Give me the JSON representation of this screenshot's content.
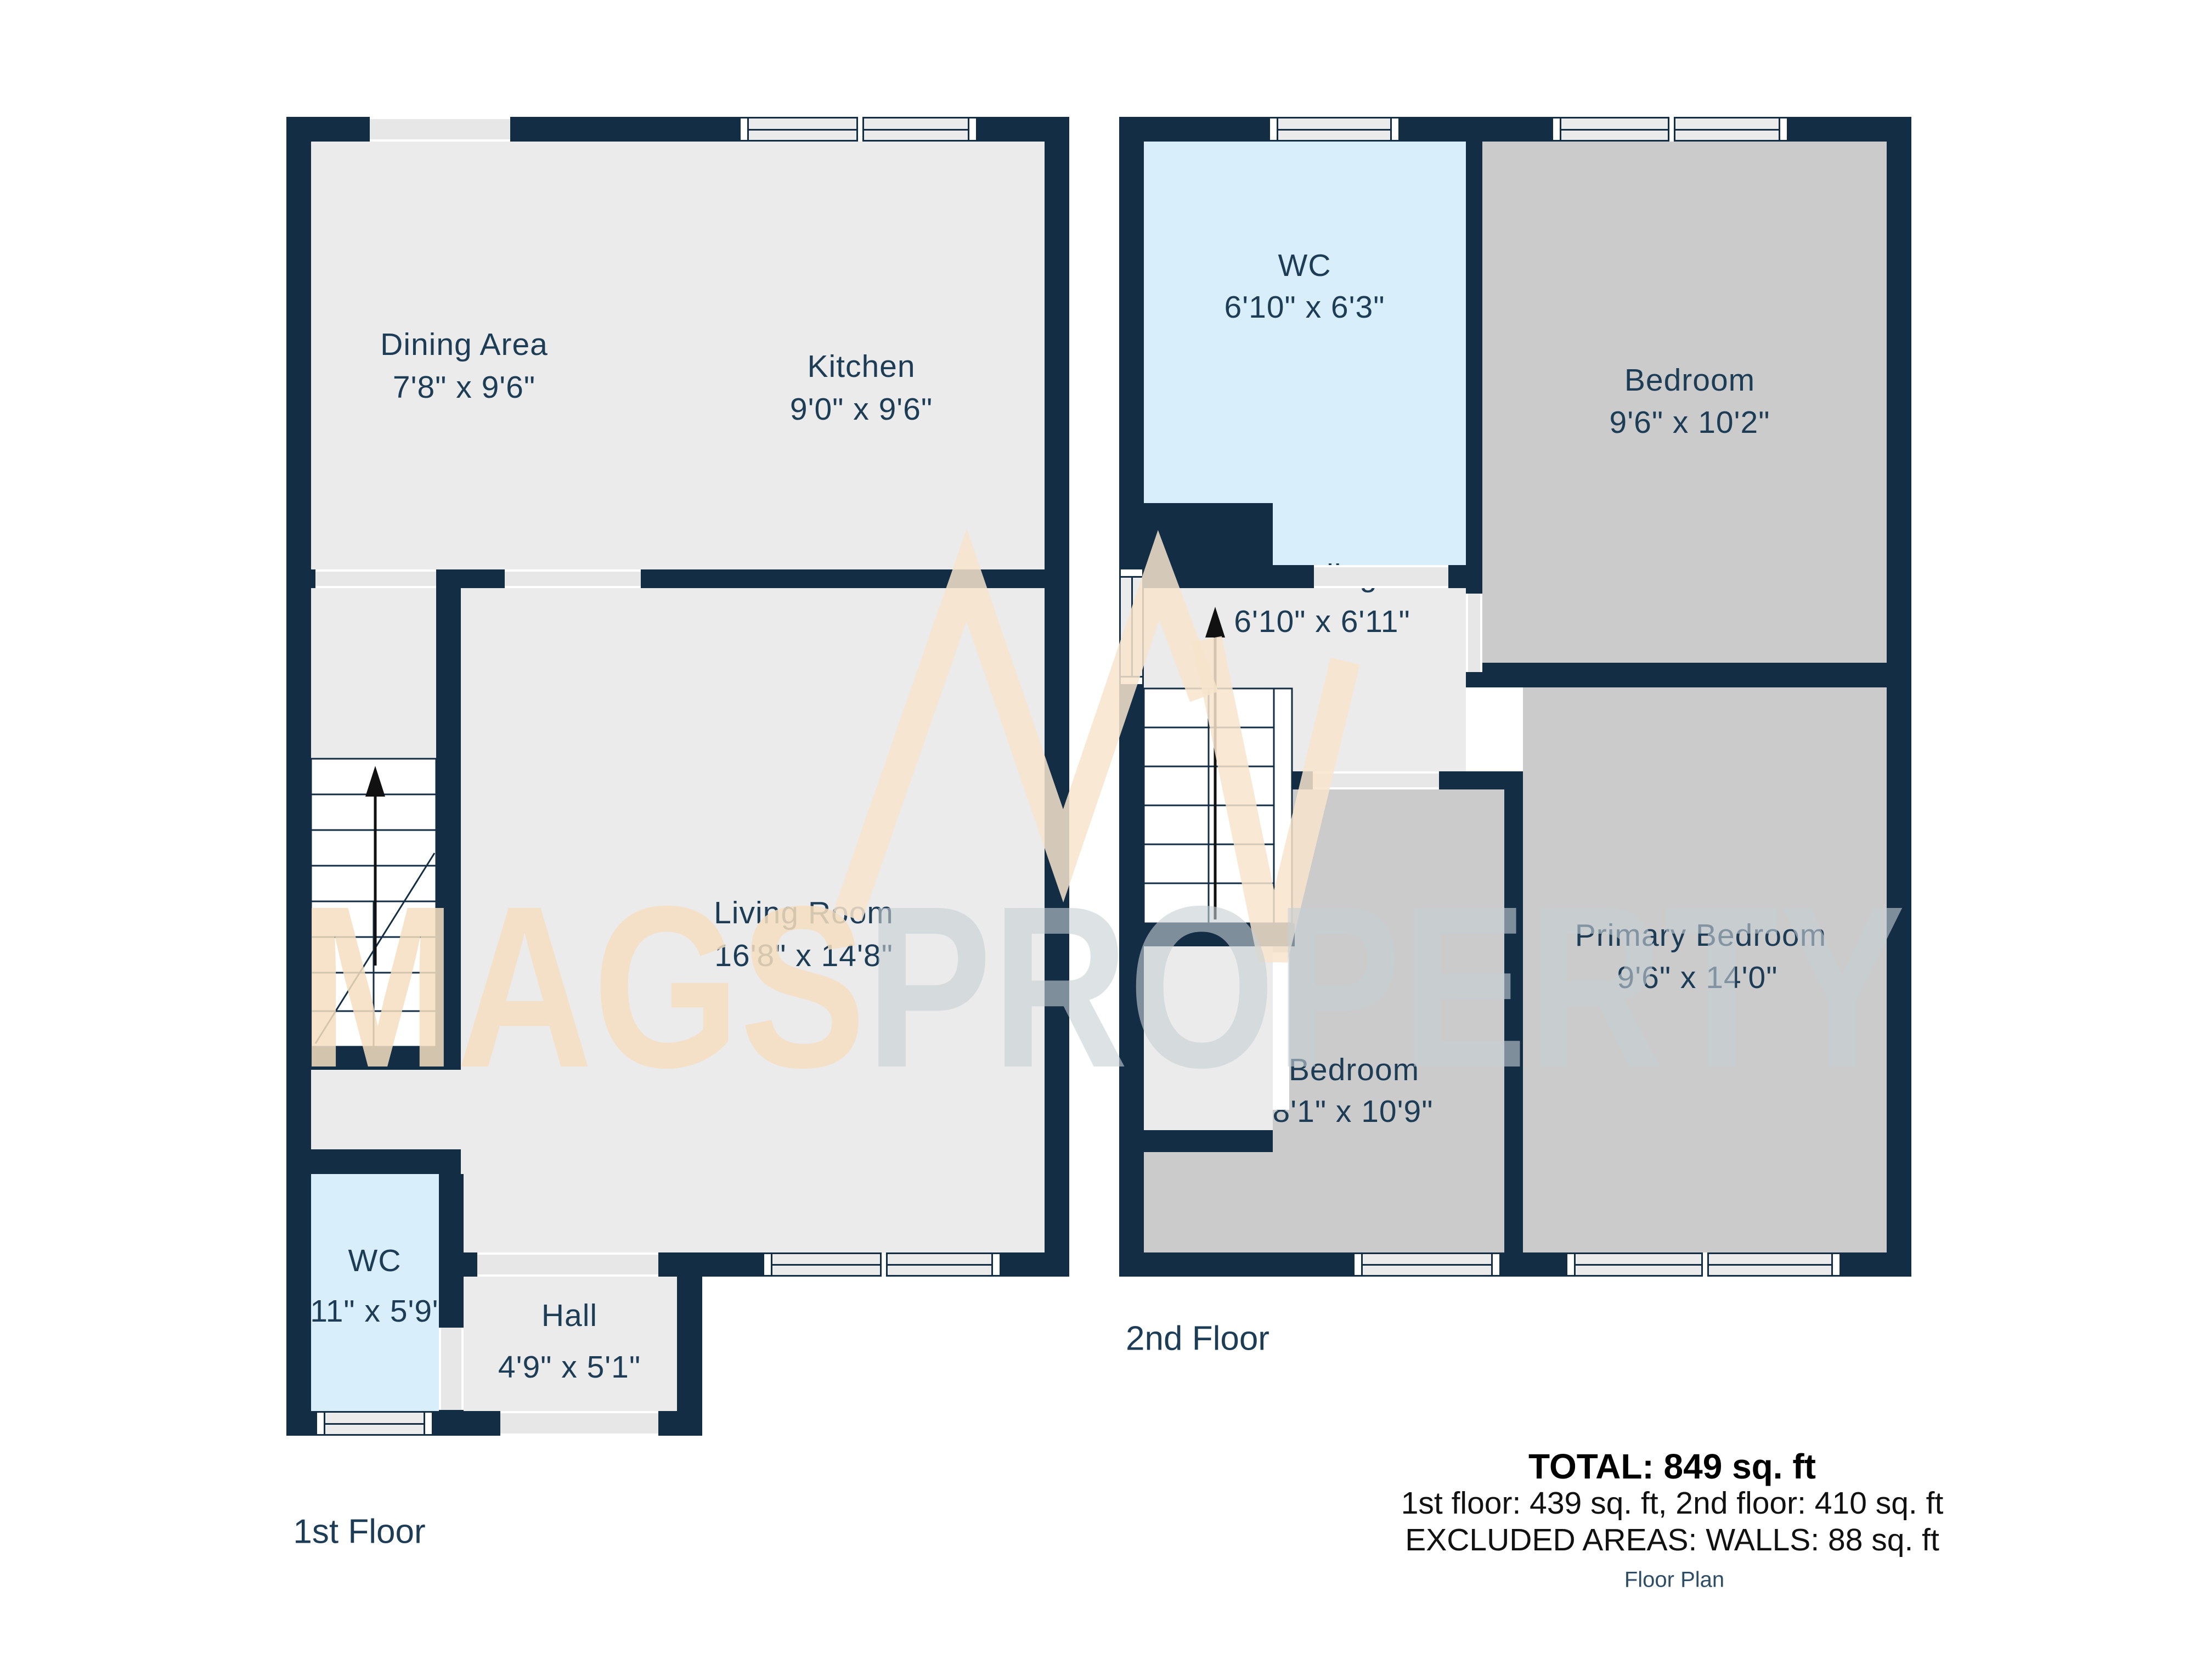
{
  "watermark": {
    "brand_left": "MAGS",
    "brand_right": "PROPERTY"
  },
  "floor1": {
    "title": "1st Floor",
    "rooms": {
      "dining": {
        "name": "Dining Area",
        "dims": "7'8\" x 9'6\""
      },
      "kitchen": {
        "name": "Kitchen",
        "dims": "9'0\" x 9'6\""
      },
      "living": {
        "name": "Living Room",
        "dims": "16'8\" x 14'8\""
      },
      "wc": {
        "name": "WC",
        "dims": "2'11\" x 5'9\""
      },
      "hall": {
        "name": "Hall",
        "dims": "4'9\" x 5'1\""
      }
    }
  },
  "floor2": {
    "title": "2nd Floor",
    "rooms": {
      "wc": {
        "name": "WC",
        "dims": "6'10\" x 6'3\""
      },
      "bedroom1": {
        "name": "Bedroom",
        "dims": "9'6\" x 10'2\""
      },
      "landing": {
        "name": "Landing",
        "dims": "6'10\" x 6'11\""
      },
      "primary": {
        "name": "Primary Bedroom",
        "dims": "9'6\" x 14'0\""
      },
      "bedroom2": {
        "name": "Bedroom",
        "dims": "8'1\" x 10'9\""
      }
    }
  },
  "summary": {
    "total": "TOTAL: 849 sq. ft",
    "floors": "1st floor: 439 sq. ft, 2nd floor: 410 sq. ft",
    "excluded": "EXCLUDED AREAS: WALLS: 88 sq. ft",
    "caption": "Floor Plan"
  },
  "colors": {
    "wall": "#132e44",
    "floor": "#ebebeb",
    "room_gray": "#cbcbcb",
    "room_blue": "#d9eefb",
    "label": "#1d3c55",
    "watermark_peach": "#f6dec1",
    "watermark_gray": "#c6ced3"
  }
}
